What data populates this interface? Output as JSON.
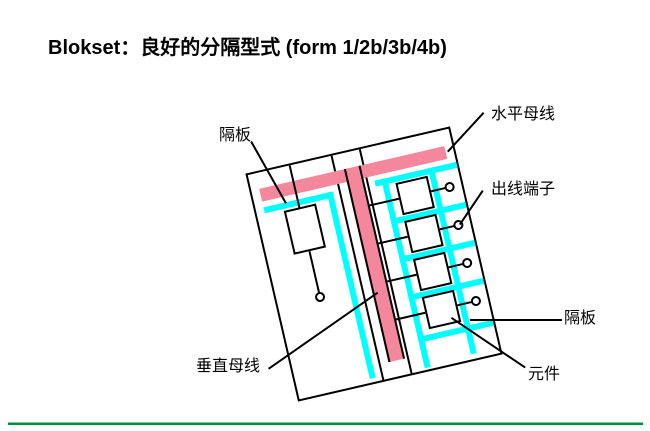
{
  "slide": {
    "title": "Blokset：良好的分隔型式 (form 1/2b/3b/4b)"
  },
  "diagram": {
    "type": "switchboard-compartment-schematic",
    "feeder_compartments": 4,
    "labels": {
      "partition_left": "隔板",
      "horizontal_busbar": "水平母线",
      "outgoing_terminal": "出线端子",
      "partition_right": "隔板",
      "component": "元件",
      "vertical_busbar": "垂直母线"
    },
    "colors": {
      "busbar_pink": "#F4879B",
      "partition_cyan": "#00FFFF",
      "outline_black": "#000000",
      "footer_rule_light": "#7BCB9B",
      "footer_rule_dark": "#008A44"
    }
  }
}
